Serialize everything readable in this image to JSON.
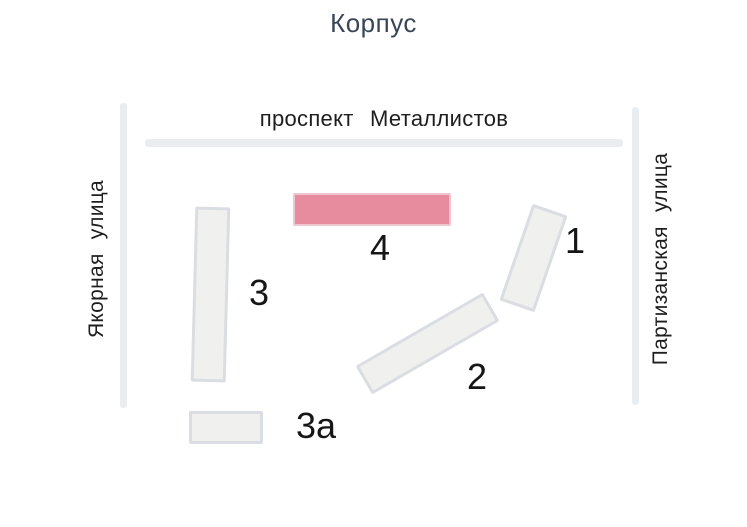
{
  "title": "Корпус",
  "streets": {
    "top": "проспект Металлистов",
    "left": "Якорная улица",
    "right": "Партизанская улица"
  },
  "buildings": [
    {
      "id": "1",
      "label": "1",
      "selected": false
    },
    {
      "id": "2",
      "label": "2",
      "selected": false
    },
    {
      "id": "3",
      "label": "3",
      "selected": false
    },
    {
      "id": "3a",
      "label": "3а",
      "selected": false
    },
    {
      "id": "4",
      "label": "4",
      "selected": true
    }
  ],
  "colors": {
    "selected_building_fill": "#e78b9e",
    "selected_building_border": "#eec6cf",
    "building_fill": "#f0f0ef",
    "building_border": "#dadde2",
    "road": "#e9edf0",
    "title_text": "#3a4657",
    "label_text": "#1e1e1e"
  }
}
